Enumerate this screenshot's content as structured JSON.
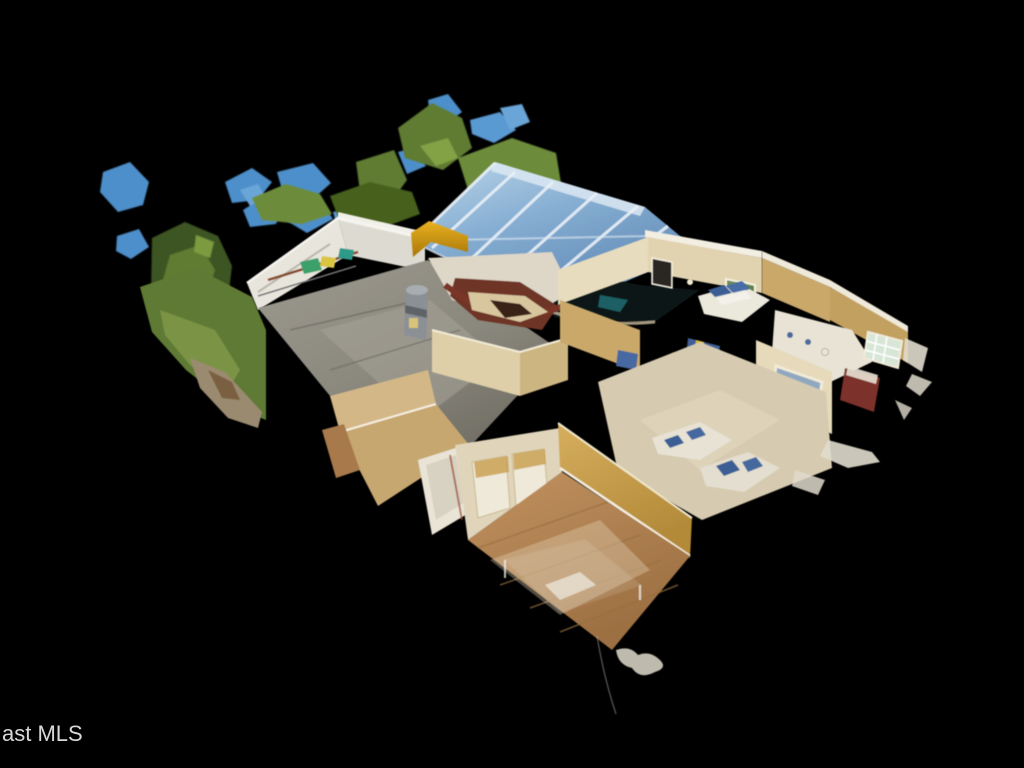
{
  "watermark": {
    "text": "ast MLS",
    "color": "#d8d8d8",
    "font_size_px": 22
  },
  "scene": {
    "type": "3d-dollhouse-scan",
    "description": "Matterport-style cutaway dollhouse 3D scan of a single-story house seen from above at an angle, floating on a solid black background with detached scan fragments of blue sky and green tree foliage",
    "background": "#000000",
    "rooms_visible": [
      "garage with concrete floor and water heater",
      "kitchen with dark mahogany cabinets and curved bar counter",
      "glass-roofed atrium over dark pool area",
      "bedroom with blue-pillow bed and framed art",
      "living room with white sofas and blue pillows",
      "bathroom with glass-block window and maroon vanity",
      "front bedroom with hardwood floor, gold wall and ghost bed outline",
      "hall bathroom with tub"
    ]
  },
  "palette": {
    "sky_fragment_blue": "#4e8fca",
    "foliage_green": "#5e7c33",
    "lawn_green": "#5f7a35",
    "glass_roof_blue": "#7fa8cd",
    "roof_frame_white": "#e9f0f7",
    "garage_wall_white": "#e7e5dc",
    "concrete_gray": "#8f8c82",
    "accent_wall_gold": "#d9a01b",
    "interior_wall_cream": "#e8dcbe",
    "interior_wall_tan": "#c9a86a",
    "tile_floor_beige": "#d6cbb0",
    "hardwood_brown": "#b5885a",
    "kitchen_cabinet_mahogany": "#6e3425",
    "sofa_white": "#e7e2d4",
    "pillow_blue": "#3a5f94",
    "pool_dark": "#0a1216",
    "water_heater_gray": "#8b9095",
    "artifact_white": "#e0dbcd"
  }
}
